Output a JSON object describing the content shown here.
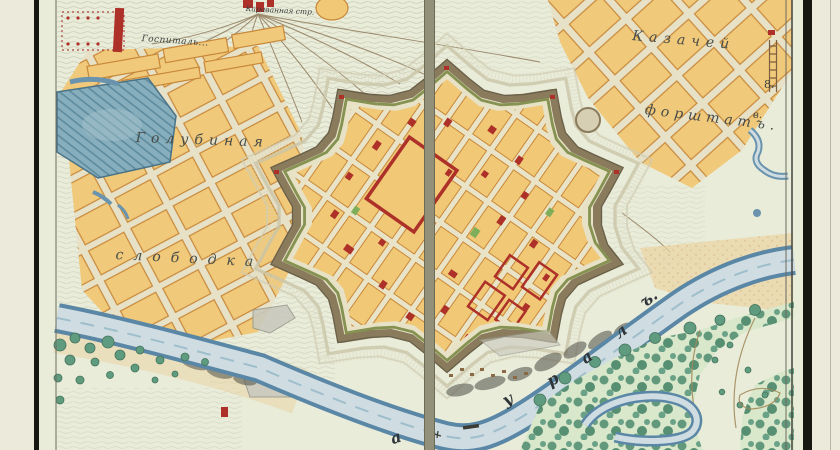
{
  "map": {
    "region_labels": {
      "hospital": "Госпиталь...",
      "caravan": "Караванная стр.",
      "golubinaya": "Голубиная",
      "slobodka": "слободка",
      "kazachey": "Казачей",
      "forshtat": "форштатъ.",
      "marker_8": "8.",
      "marker_v": "в."
    },
    "river": {
      "name": "Уралъ",
      "letters": [
        "а",
        "у",
        "р",
        "а",
        "л",
        "ъ."
      ]
    },
    "colors": {
      "parchment": "#e9ecd9",
      "margin_cream": "#eceadb",
      "frame_black": "#181611",
      "block_yellow": "#f0c876",
      "block_edge": "#c8883a",
      "building_red": "#ad3029",
      "rampart_olive": "#8a7b5c",
      "rampart_green": "#7a8a45",
      "pond_blue": "#87aebc",
      "river_fill": "#cfdde2",
      "river_edge": "#5b87a6",
      "tree_green": "#5f9b7e",
      "sand": "#ead1a0",
      "road_gray": "#93907a"
    }
  }
}
